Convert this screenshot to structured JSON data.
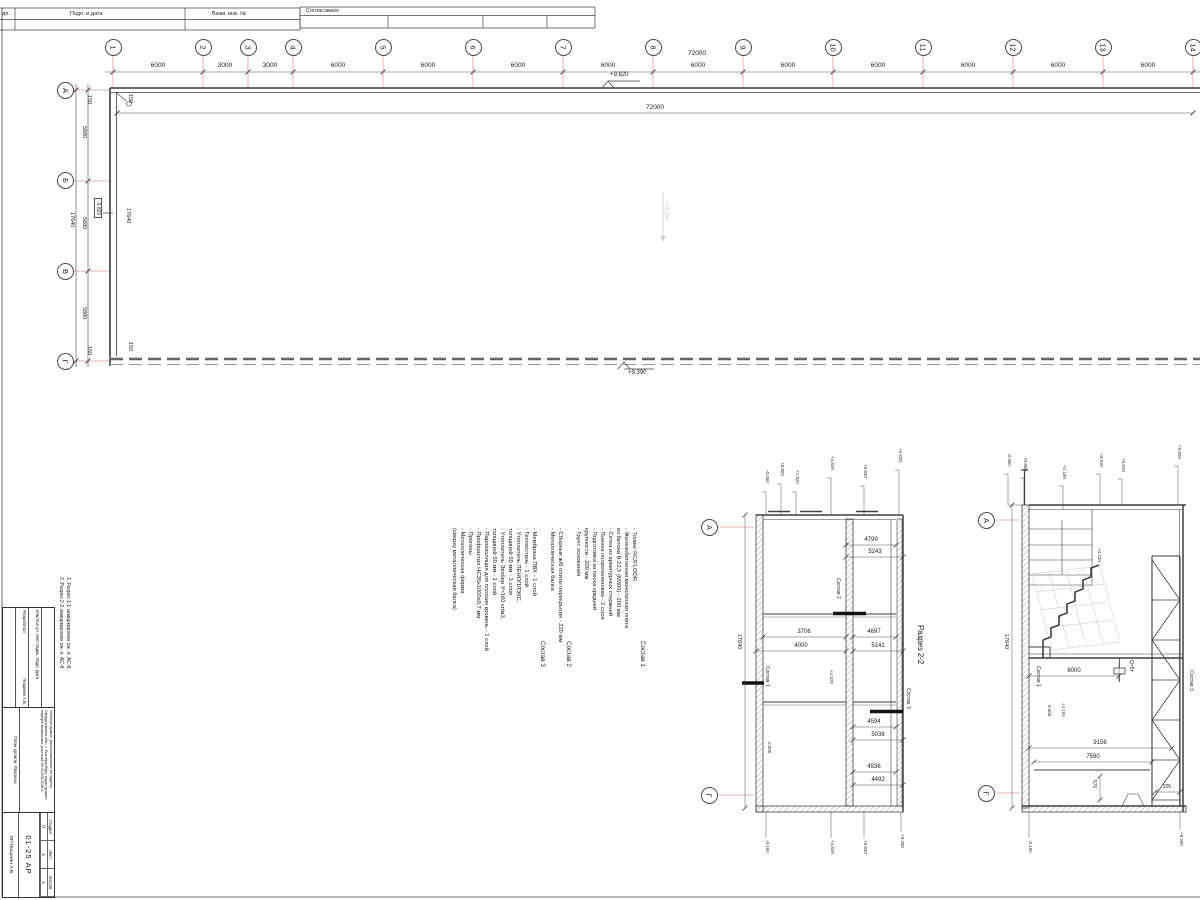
{
  "stamp": {
    "left_cut": "дл.",
    "sign_date": "Подп. и дата",
    "vzam": "Взам. инв. №",
    "agreed": "Согласовано"
  },
  "plan": {
    "axes_top": [
      "1",
      "2",
      "3",
      "4",
      "5",
      "6",
      "7",
      "8",
      "9",
      "10",
      "11",
      "12",
      "13",
      "14"
    ],
    "axes_left": [
      "А",
      "Б",
      "В",
      "Г"
    ],
    "dims_top": [
      "6000",
      "3000",
      "3000",
      "6000",
      "6000",
      "6000",
      "6000",
      "6000",
      "6000",
      "6000",
      "6000",
      "6000",
      "6000"
    ],
    "total_top": "72000",
    "total_inner": "72000",
    "dims_left": [
      "5880",
      "5880",
      "5880"
    ],
    "total_left": "17640",
    "total_left_inner": "17640",
    "off_a": "150",
    "off_b": "150",
    "off_c": "150",
    "off_d": "150",
    "elev_top": "+9.820",
    "elev_bottom": "+9.390",
    "elev_left": "-3.820",
    "slope": "i=2,5%"
  },
  "notes": {
    "n1": "1. Разрез 1-1 замаркирован см. л. АС-8.",
    "n2": "2. Разрез 2-2 замаркирован см. л. АС-8."
  },
  "comp": {
    "t1": "Состав 1",
    "b1": "- Топинг RC/FLOOR\n- Железобетонная монолитная плита\n  из бетона В 22,5 (М300)        - 200 мм\n- Сетка из арматурных стержней\n- Пленка полиэтиленовая        - 2 слоя\n- Подготовка из песка средней\n  крупности        - 200 мм\n- Грунт основания",
    "t2": "Состав 2",
    "b2": "- Сборные ж/б плиты перекрытия    - 220 мм\n- Металлическая балка",
    "t3": "Состав 3",
    "b3": "- Мембрана ПВХ        - 1 слой\n- Геотекстиль        - 1 слой\n- Утеплитель ПЕНОПЛЭКС,\n  толщиной 50 мм        - 3 слоя\n- Утеплитель Экобер У=160 кг/м3,\n  толщиной 50 мм        - 1 слой\n- Пароизоляция для плоских кровель  - 1 слой\n- Профнастил НС35х1000х0,7 мм\n- Прогоны\n- Металлическая ферма\n(сверху металлическая балка)"
  },
  "sec1": {
    "title": "Разрез 2-2",
    "axis_top": "А",
    "axis_bot": "Г",
    "vdim": "17640",
    "d1": "4799",
    "d2": "5243",
    "d3": "3706",
    "d4": "4000",
    "d5": "4697",
    "d6": "5141",
    "d7": "4594",
    "d8": "5038",
    "d9": "4936",
    "d10": "4492",
    "c1": "Состав 1",
    "c2": "Состав 2",
    "c3": "Состав 3",
    "zero": "0.000",
    "e0": "+4.320",
    "et": [
      "-0.450",
      "+0.850",
      "+1.820",
      "+4.820",
      "+5.820",
      "+9.820"
    ],
    "eb": [
      "-0.150",
      "+4.820",
      "+5.820",
      "+9.390"
    ]
  },
  "sec2": {
    "axis_top": "А",
    "axis_bot": "Г",
    "vdim": "17640",
    "d1": "6000",
    "d2": "9156",
    "d3": "7590",
    "d4": "570",
    "d5": "205",
    "c1": "Состав 1",
    "c3": "Состав 3",
    "zero": "0.000",
    "e1": "+1.104",
    "e2": "+4.220",
    "crane": "Q=5т",
    "et": [
      "-0.450",
      "+0.850",
      "+2.100",
      "+4.820",
      "+5.820",
      "+9.820"
    ],
    "eb": [
      "-0.150",
      "+9.390"
    ]
  },
  "tb": {
    "hdr": "Изм  Кол.уч.  Лист  №док.  Подп.  Дата",
    "dev": "Разработал",
    "dev_name": "Пищикян А.В.",
    "project": "«Жилые дома», расположенные по адресу: Свердловская обл., г. Екатеринбург, кадастровые номера земельных участков 66:41:0614035:4",
    "sheet_name": "План кровли. Разрезы",
    "stage_l": "Стадия",
    "list_l": "Лист",
    "lists_l": "Листов",
    "stage": "П",
    "list": "5",
    "lists": "6",
    "code": "01-25 АР",
    "company": "ИП Пищикян А.В."
  }
}
